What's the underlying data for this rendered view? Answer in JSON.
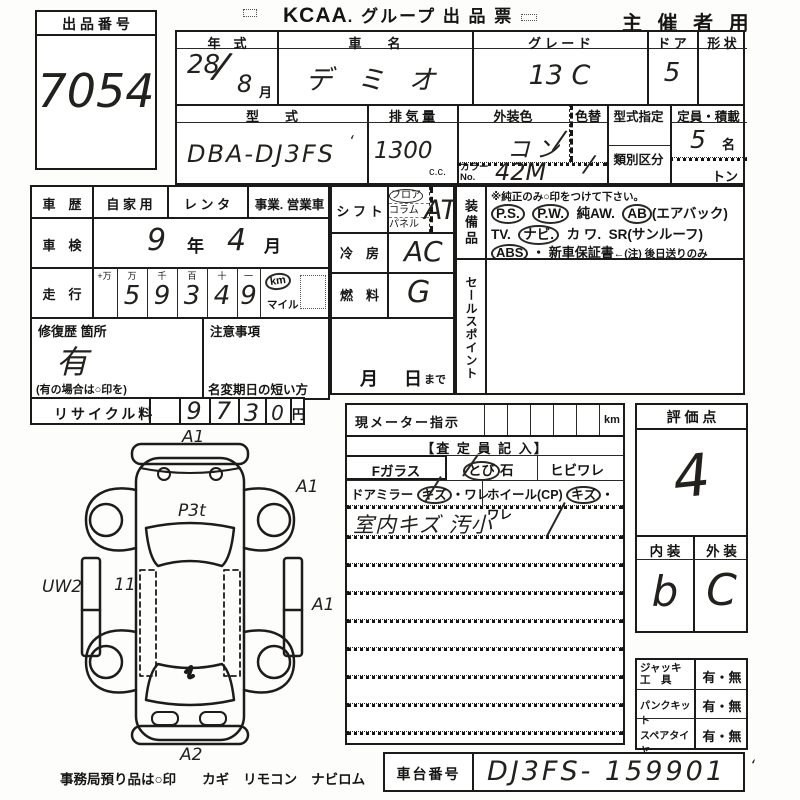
{
  "header": {
    "lot_label": "出 品 番 号",
    "lot_number": "7054",
    "brand": "KCAA",
    "title": ". グループ  出 品 票",
    "audience": "主 催 者 用"
  },
  "spec": {
    "year_label": "年　式",
    "year_value": "28",
    "year_slash": "/",
    "year_month": "8",
    "month_suffix": "月",
    "name_label": "車　　名",
    "name_value": "デ ミ オ",
    "grade_label": "グ レ ー ド",
    "grade_value": "13 C",
    "door_label": "ド ア",
    "door_value": "5",
    "shape_label": "形 状",
    "model_label": "型　　式",
    "model_value": "DBA-DJ3FS",
    "model_tick": "‘",
    "disp_label": "排 気 量",
    "disp_value": "1300",
    "disp_unit": "c.c.",
    "extcolor_label": "外装色",
    "extcolor_value": "コン",
    "extcolor_slash": "/",
    "colorchg_label": "色替",
    "colorchg_value": "/",
    "colorno_label": "カラーNo.",
    "colorno_value": "42M",
    "typedesig_label": "型式指定",
    "class_label": "類別区分",
    "capacity_label": "定員・積載",
    "capacity_value": "5",
    "capacity_unit": "名",
    "ton_unit": "トン"
  },
  "history": {
    "label": "車　歴",
    "opt_private": "自 家 用",
    "opt_rental": "レ ン タ",
    "opt_business": "事業. 営業車",
    "inspection_label": "車　検",
    "inspection_year": "9",
    "inspection_year_unit": "年",
    "inspection_month": "4",
    "inspection_month_unit": "月"
  },
  "mileage": {
    "label": "走　行",
    "col_headers": [
      "+万",
      "万",
      "千",
      "百",
      "十",
      "一"
    ],
    "digits": [
      "",
      "5",
      "9",
      "3",
      "4",
      "9"
    ],
    "unit_km": "km",
    "unit_mile": "マイル"
  },
  "repair": {
    "label": "修復歴 箇所",
    "value": "有",
    "note": "(有の場合は○印を)"
  },
  "caution": {
    "label": "注意事項",
    "name_change_label": "名変期日の短い方",
    "month_unit": "月",
    "day_unit": "日",
    "made_suffix": "まで"
  },
  "shift": {
    "label": "シ フ ト",
    "opt_floor": "フロア",
    "opt_column": "コラム",
    "opt_panel": "パネル",
    "value": "AT"
  },
  "cooling": {
    "label": "冷　房",
    "value": "AC"
  },
  "fuel": {
    "label": "燃　料",
    "value": "G"
  },
  "equipment": {
    "label": "装備品",
    "note": "※純正のみ○印をつけて下さい。",
    "ps": "P.S.",
    "pw": "P.W.",
    "aw": "純AW.",
    "ab": "AB",
    "ab_paren": "(エアバック)",
    "tv": "TV.",
    "navi": "ナビ.",
    "kawa": "カ ワ.",
    "sr": "SR(サンルーフ)",
    "abs": "ABS",
    "dot": "・",
    "warranty_main": "新車保証書",
    "warranty_note": "←(注) 後日送りのみ"
  },
  "sales_point": {
    "label": "セールスポイント"
  },
  "recycle": {
    "label": "リサイクル料",
    "digits": [
      "9",
      "7",
      "3",
      "0"
    ],
    "unit": "円"
  },
  "diagram": {
    "ann_front": "A1",
    "ann_front_right": "A1",
    "ann_hood": "P3t",
    "ann_left": "UW2",
    "ann_door": "11",
    "ann_right": "A1",
    "ann_rear": "A2"
  },
  "meter": {
    "label": "現メーター指示",
    "unit": "km"
  },
  "assessor": {
    "title": "【査 定 員 記 入】",
    "fglass_label": "Fガラス",
    "fglass_tobi": "とび",
    "fglass_ishi": "石",
    "fglass_opt2": "ヒビワレ",
    "mirror_label": "ドアミラー",
    "mirror_kizu": "キズ",
    "mirror_ware": "・ワレ",
    "wheel_label": "ホイール(CP)",
    "wheel_kizu": "キズ",
    "wheel_ware": "・ワレ",
    "note": "室内キズ 汚小"
  },
  "score": {
    "label": "評 価 点",
    "value": "4"
  },
  "grades": {
    "interior_label": "内 装",
    "exterior_label": "外 装",
    "interior_value": "b",
    "exterior_value": "C"
  },
  "accessories": {
    "jack_label1": "ジャッキ",
    "jack_label2": "工　具",
    "jack_value": "有・無",
    "puncture_label": "パンクキット",
    "puncture_value": "有・無",
    "spare_label": "スペアタイヤ",
    "spare_value": "有・無"
  },
  "chassis": {
    "label": "車台番号",
    "value": "DJ3FS- 159901",
    "tick": "‘"
  },
  "footer": {
    "note": "事務局預り品は○印",
    "item_key": "カギ",
    "item_remote": "リモコン",
    "item_navirom": "ナビロム"
  }
}
